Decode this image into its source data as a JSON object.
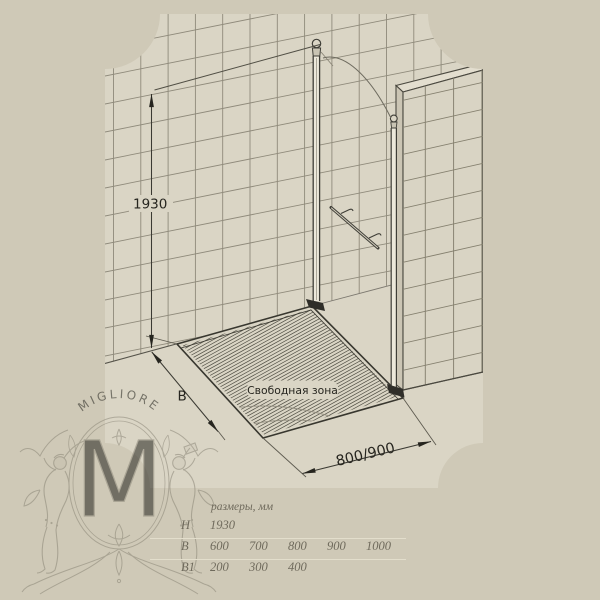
{
  "drawing": {
    "height_label": "1930",
    "depth_label": "B",
    "width_label": "800/900",
    "free_zone_label": "Свободная зона"
  },
  "watermark": {
    "brand": "MIGLIORE",
    "monogram": "M"
  },
  "table": {
    "header": "размеры, мм",
    "rows": [
      {
        "label": "H",
        "values": [
          "1930"
        ]
      },
      {
        "label": "B",
        "values": [
          "600",
          "700",
          "800",
          "900",
          "1000"
        ]
      },
      {
        "label": "B1",
        "values": [
          "200",
          "300",
          "400"
        ]
      }
    ]
  },
  "colors": {
    "outer_background": "#cfc9b7",
    "inner_background": "#dad5c5",
    "grid_line": "#8f8a7b",
    "drawing_line": "#3b3a33",
    "dimension_ink": "#26251f",
    "watermark_ink": "#8b8677",
    "table_text": "#6f6a5c"
  }
}
